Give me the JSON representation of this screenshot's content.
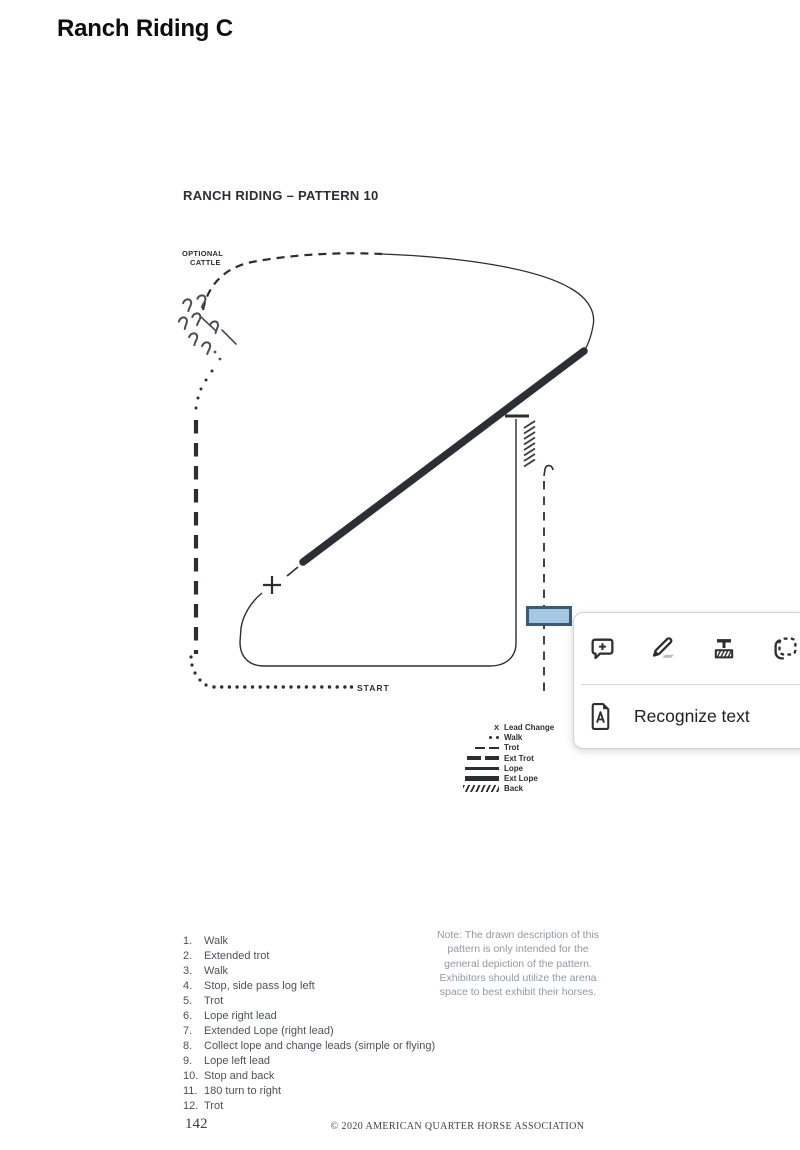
{
  "page": {
    "title": "Ranch Riding C"
  },
  "pattern": {
    "title": "RANCH RIDING – PATTERN 10",
    "optional_cattle_line1": "OPTIONAL",
    "optional_cattle_line2": "CATTLE",
    "start_label": "START",
    "lead_change_marker": "+"
  },
  "legend": {
    "items": [
      {
        "symbol": "lead-change-x",
        "marker": "X",
        "label": "Lead Change"
      },
      {
        "symbol": "walk-dots",
        "label": "Walk"
      },
      {
        "symbol": "trot-dashes",
        "label": "Trot"
      },
      {
        "symbol": "ext-trot-dashes",
        "label": "Ext Trot"
      },
      {
        "symbol": "lope-line",
        "label": "Lope"
      },
      {
        "symbol": "ext-lope-line",
        "label": "Ext Lope"
      },
      {
        "symbol": "back-hatches",
        "label": "Back"
      }
    ]
  },
  "instructions": {
    "items": [
      {
        "num": "1.",
        "text": "Walk"
      },
      {
        "num": "2.",
        "text": "Extended trot"
      },
      {
        "num": "3.",
        "text": "Walk"
      },
      {
        "num": "4.",
        "text": "Stop, side pass log left"
      },
      {
        "num": "5.",
        "text": "Trot"
      },
      {
        "num": "6.",
        "text": "Lope right lead"
      },
      {
        "num": "7.",
        "text": "Extended Lope (right lead)"
      },
      {
        "num": "8.",
        "text": "Collect lope and change leads (simple or flying)"
      },
      {
        "num": "9.",
        "text": "Lope left lead"
      },
      {
        "num": "10.",
        "text": "Stop and back"
      },
      {
        "num": "11.",
        "text": "180 turn to right"
      },
      {
        "num": "12.",
        "text": "Trot"
      }
    ]
  },
  "note": {
    "text": "Note: The drawn description of this\npattern is only intended for the\ngeneral depiction of the pattern.\nExhibitors should utilize the arena\nspace to best exhibit their horses."
  },
  "footer": {
    "page_number": "142",
    "copyright": "© 2020 AMERICAN QUARTER HORSE ASSOCIATION"
  },
  "annotation_menu": {
    "recognize_text_label": "Recognize text"
  },
  "selection": {
    "fill": "#a5c8e2",
    "border": "#3c5a74"
  },
  "colors": {
    "ink": "#2b2e34",
    "list_text": "#4d525a",
    "note_text": "#9298a2",
    "footer_text": "#3b4048"
  }
}
